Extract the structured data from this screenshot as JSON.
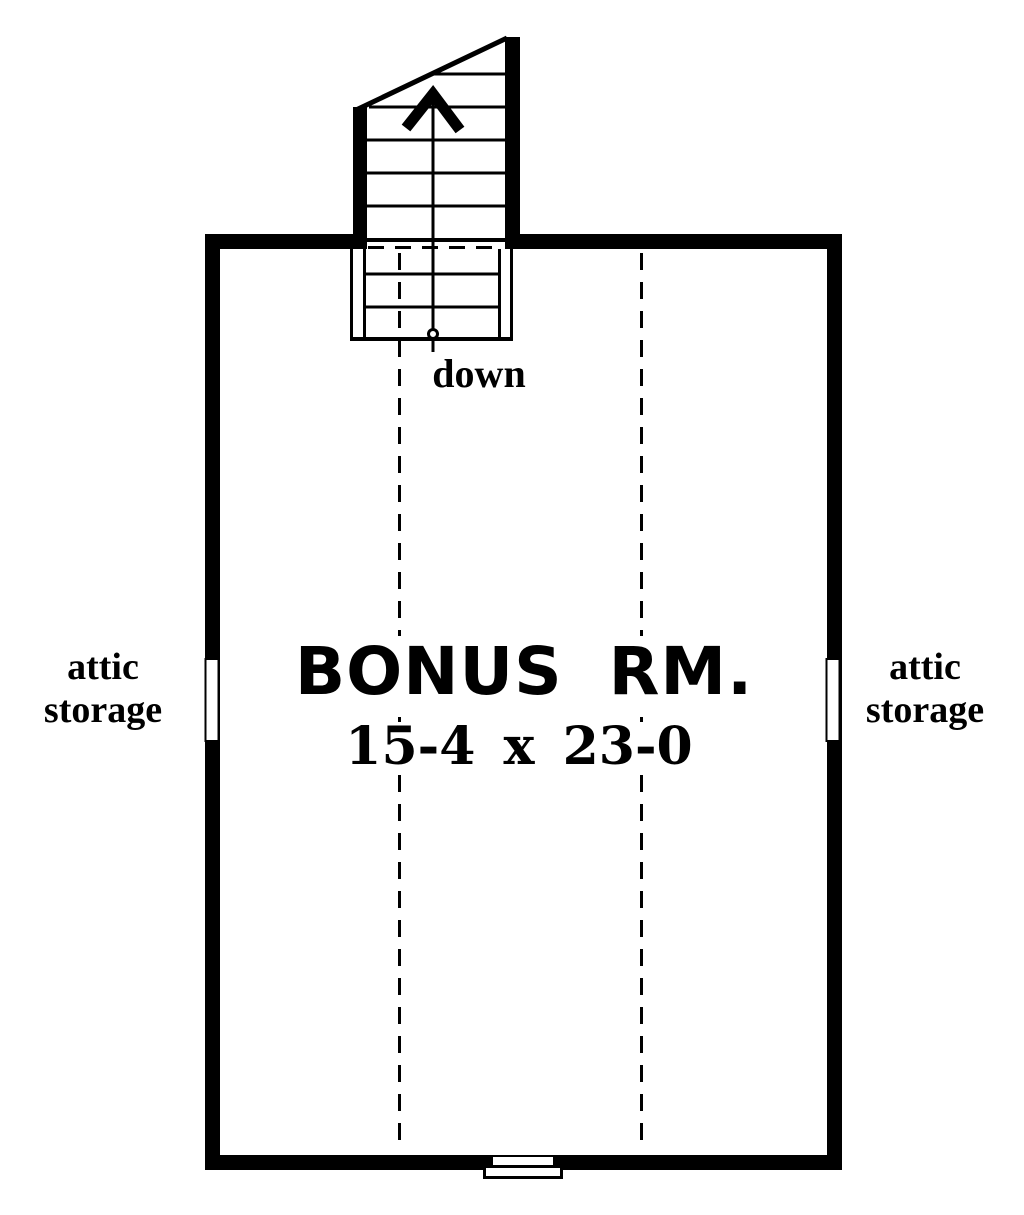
{
  "plan": {
    "title": "BONUS RM.",
    "dimensions": "15-4 x 23-0",
    "stairs": {
      "direction_label": "down"
    },
    "attic_storage_left": {
      "line1": "attic",
      "line2": "storage"
    },
    "attic_storage_right": {
      "line1": "attic",
      "line2": "storage"
    },
    "colors": {
      "line": "#000000",
      "background": "#ffffff"
    }
  }
}
